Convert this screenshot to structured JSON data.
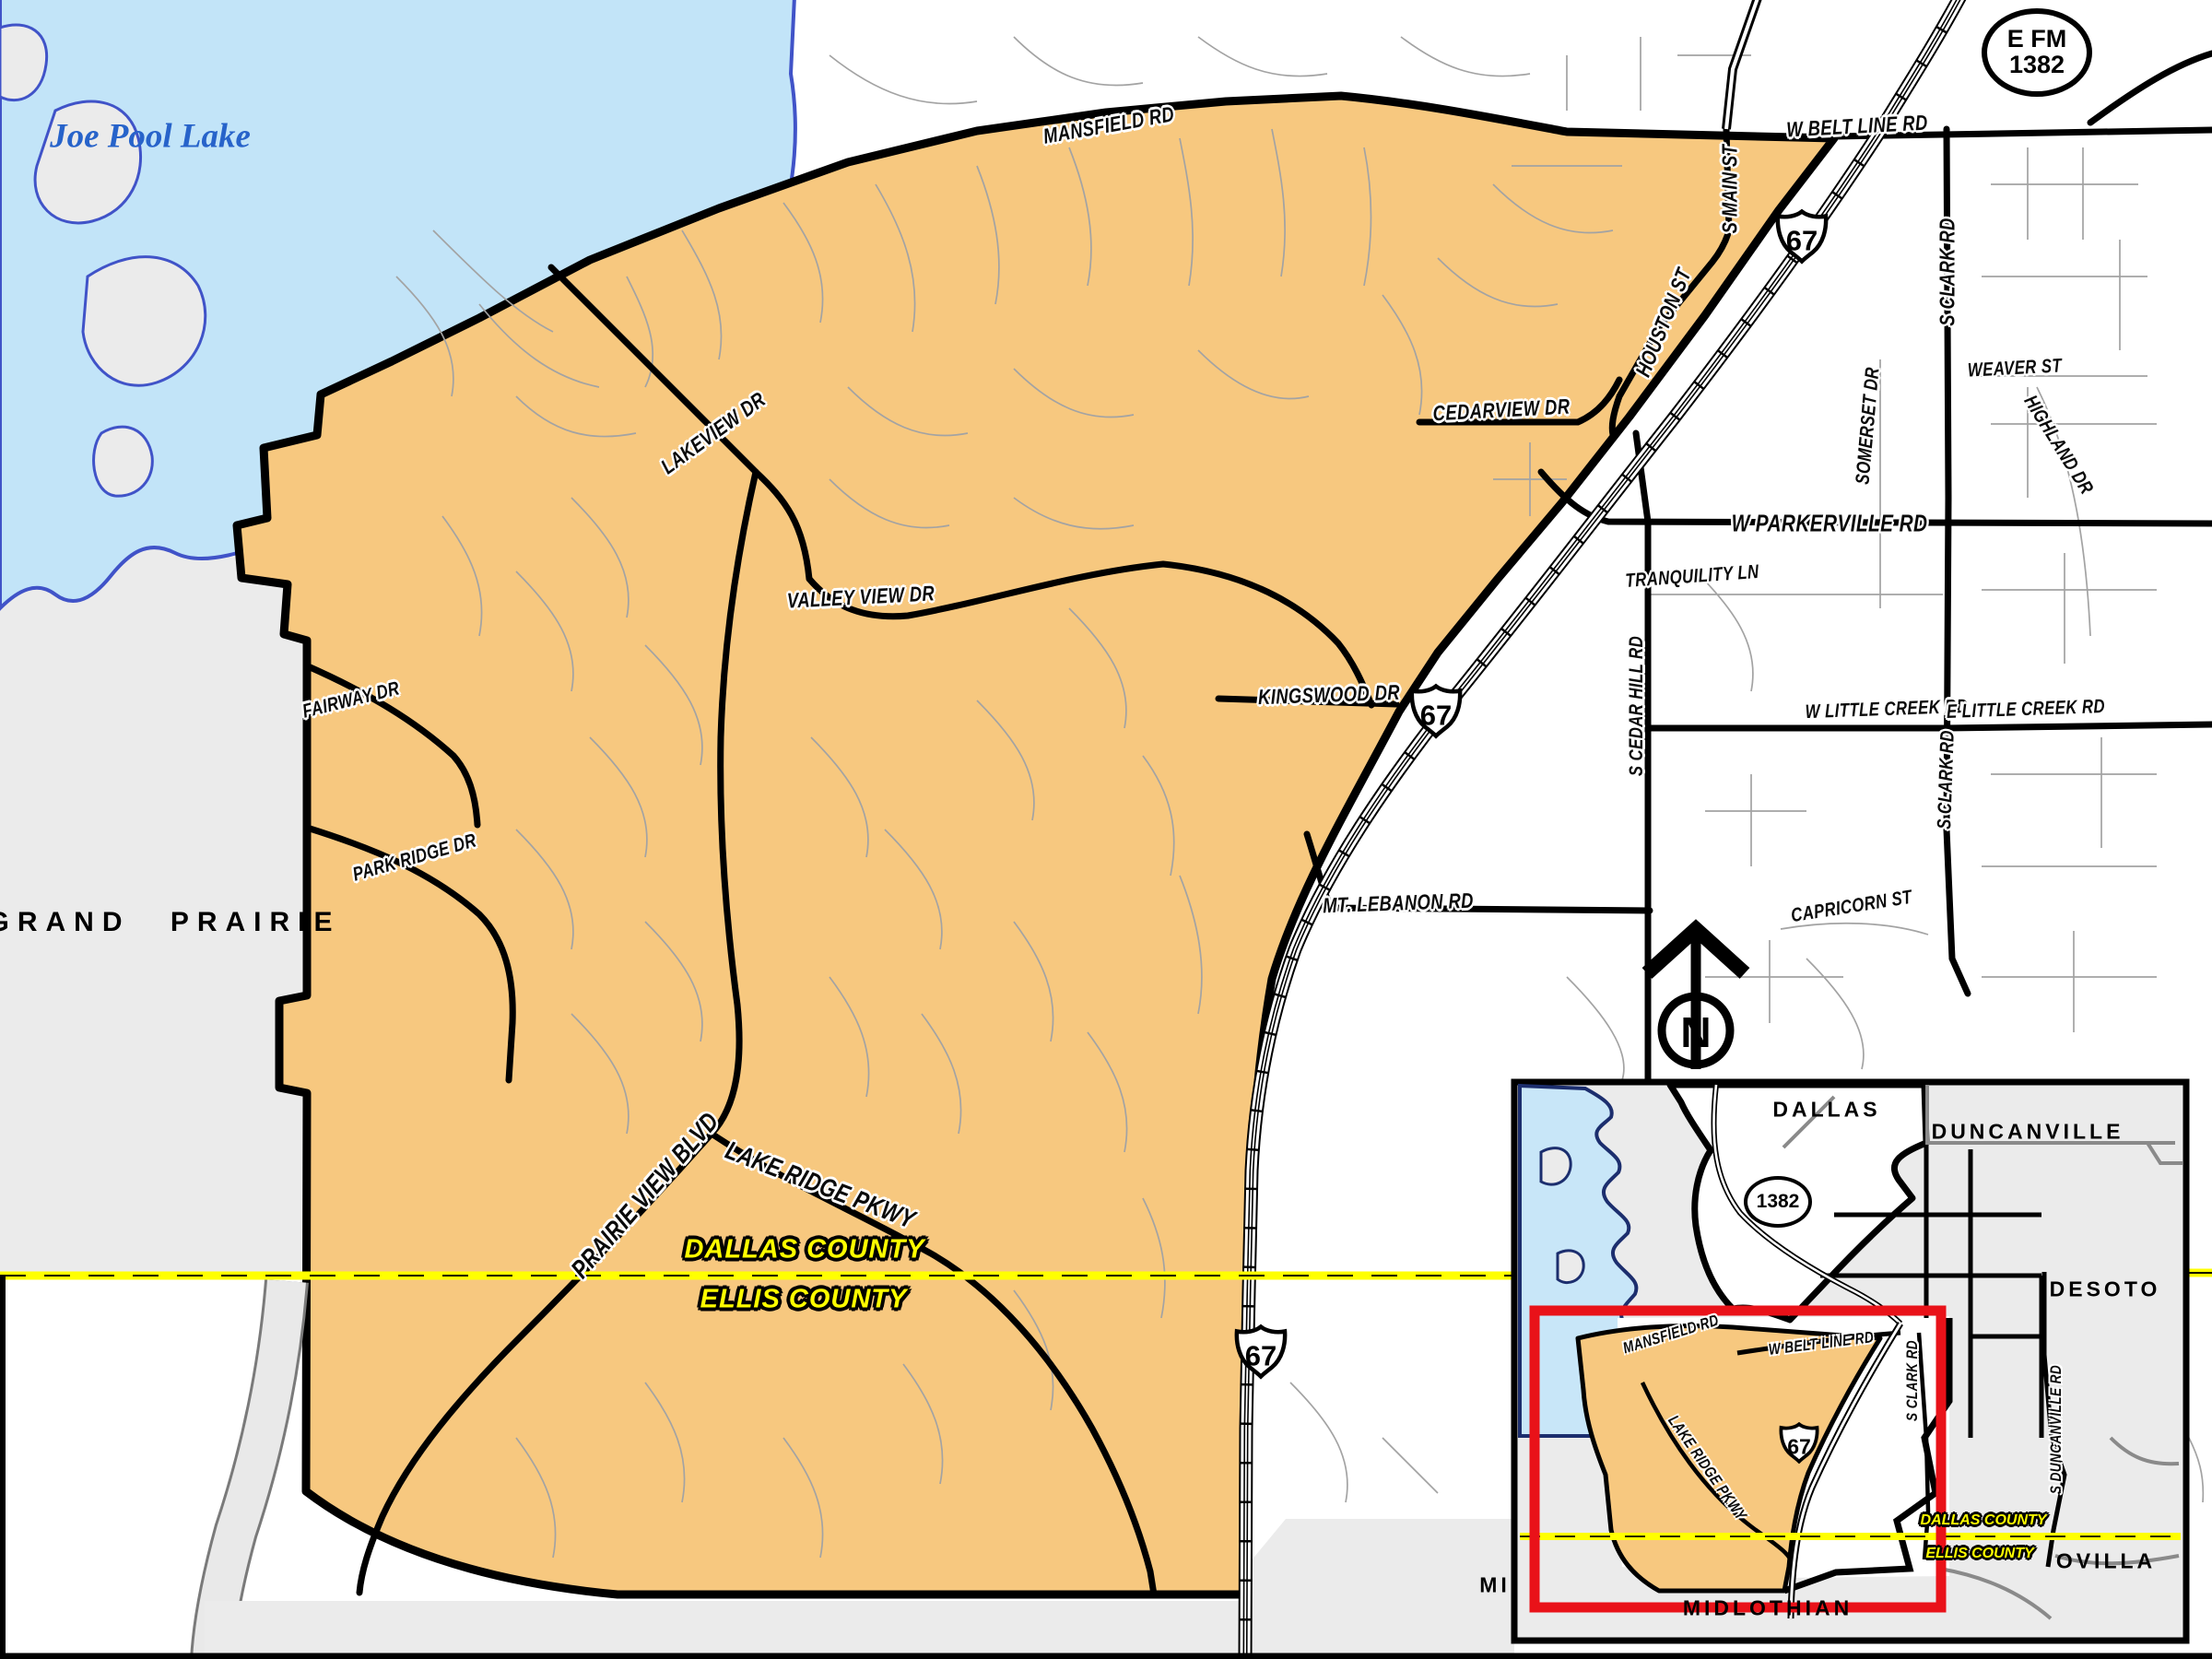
{
  "map": {
    "labels": {
      "joe_pool_lake": "Joe Pool Lake",
      "grand_prairie": "GRAND PRAIRIE",
      "dallas_county": "DALLAS COUNTY",
      "ellis_county": "ELLIS COUNTY",
      "midlothian_partial": "MI",
      "north": "N"
    },
    "roads": {
      "mansfield": "MANSFIELD RD",
      "belt_line": "W BELT LINE RD",
      "s_main": "S MAIN ST",
      "houston": "HOUSTON ST",
      "s_clark": "S CLARK RD",
      "weaver": "WEAVER ST",
      "highland": "HIGHLAND DR",
      "somerset": "SOMERSET DR",
      "parkerville": "W PARKERVILLE RD",
      "tranquility": "TRANQUILITY LN",
      "cedar_hill": "S CEDAR HILL RD",
      "cedarview": "CEDARVIEW DR",
      "lakeview": "LAKEVIEW DR",
      "valley_view": "VALLEY VIEW DR",
      "kingswood": "KINGSWOOD DR",
      "w_little_creek": "W LITTLE CREEK RD",
      "e_little_creek": "E LITTLE CREEK RD",
      "capricorn": "CAPRICORN ST",
      "mt_lebanon": "MT. LEBANON RD",
      "fairway": "FAIRWAY DR",
      "park_ridge": "PARK RIDGE DR",
      "prairie_view": "PRAIRIE VIEW BLVD",
      "lake_ridge": "LAKE RIDGE PKWY"
    },
    "shields": {
      "us67": "67",
      "efm_line1": "E FM",
      "efm_line2": "1382"
    }
  },
  "inset": {
    "cities": {
      "dallas": "DALLAS",
      "duncanville": "DUNCANVILLE",
      "desoto": "DESOTO",
      "ovilla": "OVILLA",
      "midlothian": "MIDLOTHIAN"
    },
    "roads": {
      "mansfield": "MANSFIELD RD",
      "belt_line": "W BELT LINE RD",
      "s_clark": "S CLARK RD",
      "lake_ridge": "LAKE RIDGE PKWY",
      "s_duncanville": "S DUNCANVILLE RD"
    },
    "counties": {
      "dallas": "DALLAS COUNTY",
      "ellis": "ELLIS COUNTY"
    },
    "shields": {
      "fm1382": "1382",
      "us67": "67"
    }
  },
  "colors": {
    "highlight": "#F7C87F",
    "lake": "#C2E4F8",
    "lake_border": "#4053C8",
    "inset_lake_border": "#1C2E6E",
    "county_line": "#FFFF00",
    "red_box": "#E91219",
    "land_grey": "#EBEBEB"
  }
}
